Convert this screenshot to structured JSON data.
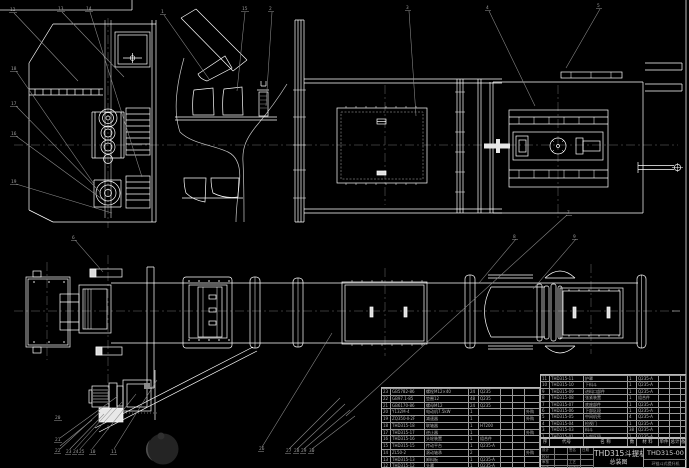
{
  "sheet": {
    "title": "THD315斗提机",
    "subtitle": "总装图",
    "drawing_no": "THD315-00",
    "org_line": "环链斗式提升机",
    "fields": {
      "design": "设计",
      "check": "校对",
      "review": "审核",
      "approve": "批准",
      "sign": "签名",
      "date": "日期",
      "craft": "工艺",
      "std": "标准化"
    }
  },
  "bom": {
    "header": [
      "序号",
      "代号",
      "名  称",
      "数量",
      "材  料",
      "单件",
      "总计",
      "备注"
    ],
    "left_rows": [
      [
        "23",
        "GB5782-86",
        "螺栓M12×40",
        "24",
        "Q235",
        "",
        "",
        ""
      ],
      [
        "22",
        "GB97.1-85",
        "垫圈12",
        "48",
        "Q235",
        "",
        "",
        ""
      ],
      [
        "21",
        "GB6170-86",
        "螺母M12",
        "24",
        "Q235",
        "",
        "",
        ""
      ],
      [
        "20",
        "Y132M-4",
        "电动机7.5kW",
        "1",
        "",
        "",
        "",
        "外购"
      ],
      [
        "19",
        "ZQ350-Ⅱ-2F",
        "减速器",
        "1",
        "",
        "",
        "",
        "外购"
      ],
      [
        "18",
        "THD315-18",
        "联轴器",
        "1",
        "HT200",
        "",
        "",
        ""
      ],
      [
        "17",
        "THD315-17",
        "逆止器",
        "1",
        "",
        "",
        "",
        "外购"
      ],
      [
        "16",
        "THD315-16",
        "头轮装置",
        "1",
        "组合件",
        "",
        "",
        ""
      ],
      [
        "15",
        "THD315-15",
        "传动平台",
        "1",
        "Q235-A",
        "",
        "",
        ""
      ],
      [
        "14",
        "ZL50-2",
        "滚动轴承",
        "2",
        "",
        "",
        "",
        "外购"
      ],
      [
        "13",
        "THD315-13",
        "卸料板",
        "1",
        "Q235-A",
        "",
        "",
        ""
      ],
      [
        "12",
        "THD315-12",
        "头罩",
        "1",
        "Q235-A",
        "",
        "",
        ""
      ]
    ],
    "right_rows": [
      [
        "11",
        "THD315-11",
        "护罩",
        "1",
        "Q235-A",
        "",
        "",
        ""
      ],
      [
        "10",
        "THD315-10",
        "下料斗",
        "1",
        "Q235-A",
        "",
        "",
        ""
      ],
      [
        "9",
        "THD315-09",
        "进料口部件",
        "1",
        "Q235-A",
        "",
        "",
        ""
      ],
      [
        "8",
        "THD315-08",
        "张紧装置",
        "1",
        "组合件",
        "",
        "",
        ""
      ],
      [
        "7",
        "THD315-07",
        "底座部件",
        "1",
        "Q235-A",
        "",
        "",
        ""
      ],
      [
        "6",
        "THD315-06",
        "下部区段",
        "1",
        "Q235-A",
        "",
        "",
        ""
      ],
      [
        "5",
        "THD315-05",
        "中间机壳",
        "4",
        "Q235-A",
        "",
        "",
        ""
      ],
      [
        "4",
        "THD315-04",
        "检视门",
        "1",
        "Q235-A",
        "",
        "",
        ""
      ],
      [
        "3",
        "THD315-03",
        "料斗",
        "38",
        "Q235-A",
        "",
        "",
        ""
      ],
      [
        "1",
        "THD315-01",
        "上部区段",
        "1",
        "Q235-A",
        "",
        "",
        ""
      ]
    ]
  },
  "balloons": {
    "labels": [
      "12",
      "13",
      "14",
      "1",
      "15",
      "2",
      "3",
      "4",
      "5",
      "18",
      "17",
      "16",
      "19",
      "6",
      "8",
      "9",
      "7",
      "20",
      "21",
      "22",
      "23",
      "24",
      "25",
      "10",
      "11",
      "26",
      "27",
      "28",
      "29",
      "30"
    ]
  }
}
